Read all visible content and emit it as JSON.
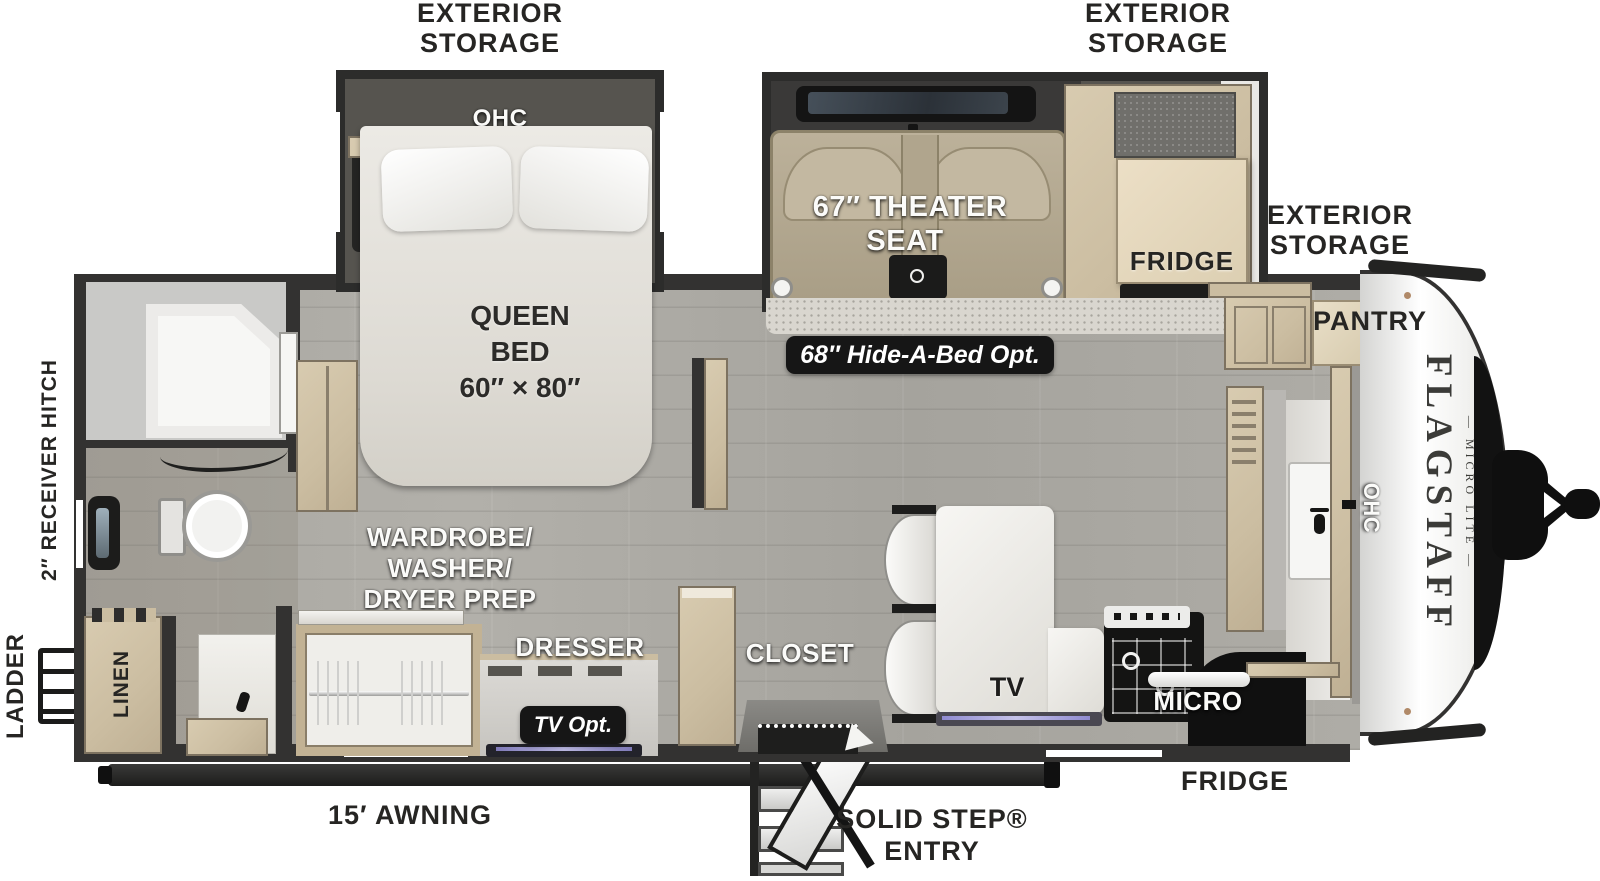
{
  "page": {
    "background": "#ffffff"
  },
  "colors": {
    "walls": "#333231",
    "cabinet_wood": "#d3c5aa",
    "floor": "#a9a7a1",
    "seat_fabric": "#b2a78f",
    "badge_bg": "#161616",
    "label_black": "#262523",
    "label_white": "#fbfbf9"
  },
  "brand": {
    "logo": "FLAGSTAFF",
    "logo_sub": "— MICRO LITE —"
  },
  "exterior": {
    "storage_rear": [
      "EXTERIOR",
      "STORAGE"
    ],
    "storage_front": [
      "EXTERIOR",
      "STORAGE"
    ],
    "storage_side": [
      "EXTERIOR",
      "STORAGE"
    ],
    "awning": "15′ AWNING",
    "entry": [
      "SOLID STEP®",
      "ENTRY"
    ],
    "receiver_hitch": "2″ RECEIVER HITCH",
    "ladder": "LADDER",
    "fridge": "FRIDGE"
  },
  "bedroom": {
    "ohc": "OHC",
    "bed": [
      "QUEEN",
      "BED",
      "60″ × 80″"
    ],
    "wardrobe": [
      "WARDROBE/",
      "WASHER/",
      "DRYER PREP"
    ],
    "dresser": "DRESSER",
    "tv_opt": "TV Opt.",
    "closet": "CLOSET"
  },
  "bathroom": {
    "linen": "LINEN"
  },
  "living": {
    "theater_seat": [
      "67″ THEATER",
      "SEAT"
    ],
    "hide_a_bed": "68″ Hide-A-Bed Opt.",
    "fridge": "FRIDGE",
    "tv": "TV"
  },
  "kitchen": {
    "pantry": "PANTRY",
    "ohc": "OHC",
    "micro": "MICRO"
  }
}
